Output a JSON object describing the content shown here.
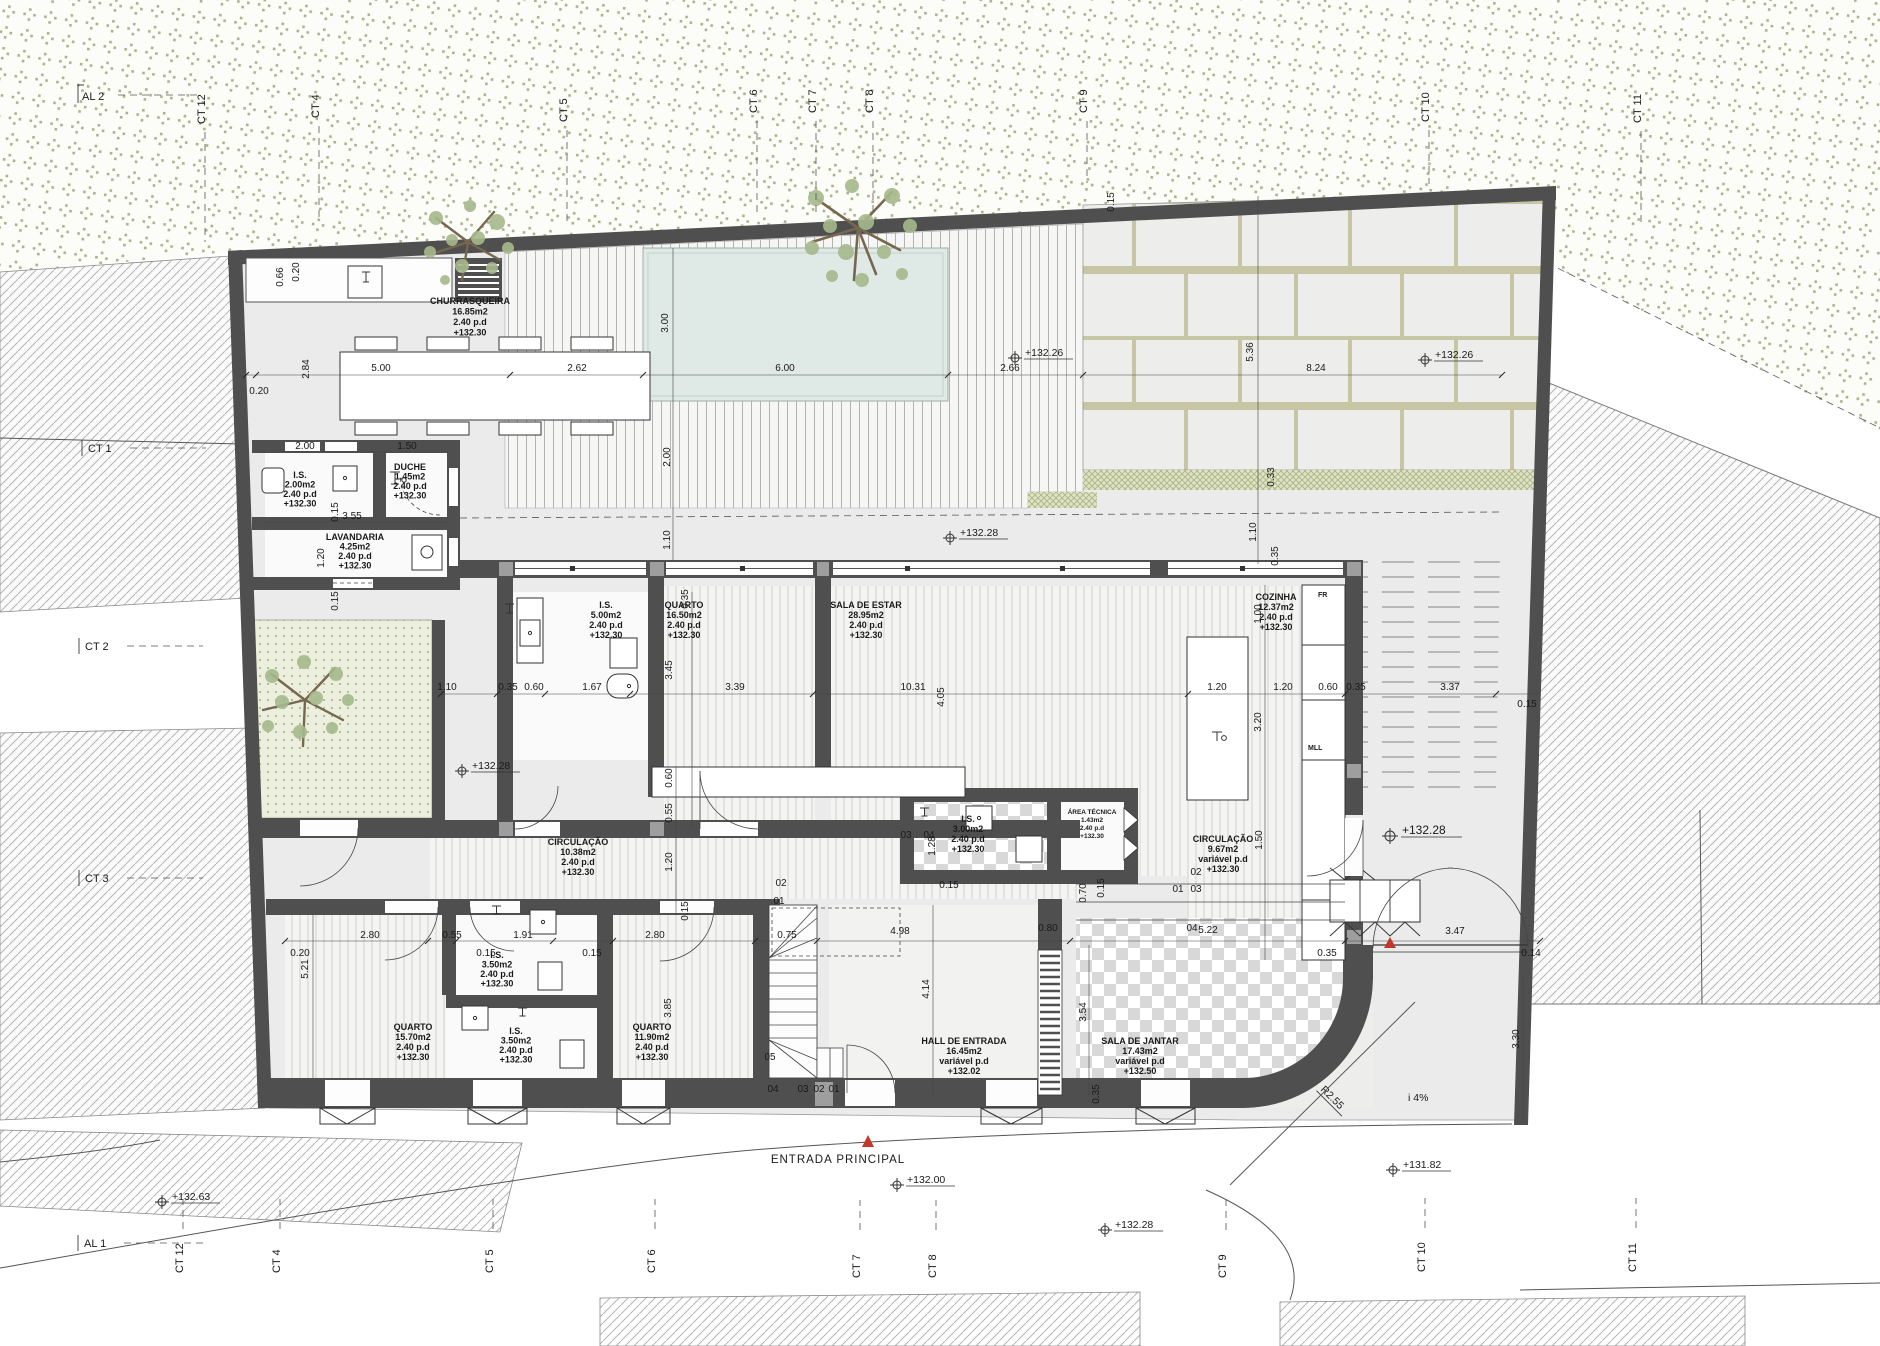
{
  "drawing": {
    "type": "architectural floor plan",
    "entrance_label": "ENTRADA PRINCIPAL",
    "slope_label": "i 4%",
    "radius_label": "R2.55"
  },
  "colors": {
    "wall": "#4f4f4f",
    "pier": "#9e9e9e",
    "pool": "#dfe9e5",
    "vegetation": "#9aa77a",
    "accent_red": "#c0392b",
    "paper": "#ffffff"
  },
  "markers": {
    "top": [
      "AL 2",
      "CT 12",
      "CT 4",
      "CT 5",
      "CT 6",
      "CT 7",
      "CT 8",
      "CT 9",
      "CT 10",
      "CT 11"
    ],
    "left": [
      "CT 1",
      "CT 2",
      "CT 3"
    ],
    "bottom": [
      "AL 1",
      "CT 12",
      "CT 4",
      "CT 5",
      "CT 6",
      "CT 7",
      "CT 8",
      "CT 9",
      "CT 10",
      "CT 11"
    ]
  },
  "rooms": [
    {
      "name": "CHURRASQUEIRA",
      "area": "16.85m2",
      "ceiling": "2.40 p.d",
      "level": "+132.30"
    },
    {
      "name": "I.S.",
      "area": "2.00m2",
      "ceiling": "2.40 p.d",
      "level": "+132.30"
    },
    {
      "name": "DUCHE",
      "area": "1.45m2",
      "ceiling": "2.40 p.d",
      "level": "+132.30"
    },
    {
      "name": "LAVANDARIA",
      "area": "4.25m2",
      "ceiling": "2.40 p.d",
      "level": "+132.30"
    },
    {
      "name": "I.S.",
      "area": "5.00m2",
      "ceiling": "2.40 p.d",
      "level": "+132.30"
    },
    {
      "name": "QUARTO",
      "area": "16.50m2",
      "ceiling": "2.40 p.d",
      "level": "+132.30"
    },
    {
      "name": "SALA DE ESTAR",
      "area": "28.95m2",
      "ceiling": "2.40 p.d",
      "level": "+132.30"
    },
    {
      "name": "COZINHA",
      "area": "12.37m2",
      "ceiling": "2.40 p.d",
      "level": "+132.30"
    },
    {
      "name": "CIRCULAÇÃO",
      "area": "10.38m2",
      "ceiling": "2.40 p.d",
      "level": "+132.30"
    },
    {
      "name": "I.S.",
      "area": "3.00m2",
      "ceiling": "2.40 p.d",
      "level": "+132.30"
    },
    {
      "name": "ÁREA TÉCNICA",
      "area": "1.43m2",
      "ceiling": "2.40 p.d",
      "level": "+132.30"
    },
    {
      "name": "CIRCULAÇÃO",
      "area": "9.67m2",
      "ceiling": "variável p.d",
      "level": "+132.30"
    },
    {
      "name": "QUARTO",
      "area": "15.70m2",
      "ceiling": "2.40 p.d",
      "level": "+132.30"
    },
    {
      "name": "I.S.",
      "area": "3.50m2",
      "ceiling": "2.40 p.d",
      "level": "+132.30"
    },
    {
      "name": "I.S.",
      "area": "3.50m2",
      "ceiling": "2.40 p.d",
      "level": "+132.30"
    },
    {
      "name": "QUARTO",
      "area": "11.90m2",
      "ceiling": "2.40 p.d",
      "level": "+132.30"
    },
    {
      "name": "HALL DE ENTRADA",
      "area": "16.45m2",
      "ceiling": "variável p.d",
      "level": "+132.02"
    },
    {
      "name": "SALA DE JANTAR",
      "area": "17.43m2",
      "ceiling": "variável p.d",
      "level": "+132.50"
    }
  ],
  "appliances": {
    "fridge": "FR",
    "dishwasher": "MLL"
  },
  "elevations": {
    "deck": "+132.26",
    "patio": "+132.26",
    "terrace": "+132.28",
    "courtyard": "+132.28",
    "side_gate": "+132.28",
    "street_mid": "+132.28",
    "street_left": "+132.63",
    "street_front": "+132.00",
    "driveway": "+131.82"
  },
  "dims": [
    "0.20",
    "5.00",
    "2.62",
    "6.00",
    "2.66",
    "8.24",
    "0.66",
    "0.20",
    "2.84",
    "3.00",
    "2.00",
    "1.10",
    "5.36",
    "0.33",
    "1.10",
    "0.35",
    "2.00",
    "1.50",
    "3.55",
    "1.20",
    "0.15",
    "0.15",
    "1.10",
    "0.35",
    "0.60",
    "1.67",
    "3.45",
    "0.35",
    "3.39",
    "10.31",
    "4.05",
    "0.60",
    "0.55",
    "1.20",
    "0.15",
    "1.00",
    "1.20",
    "1.20",
    "0.60",
    "0.35",
    "3.20",
    "3.37",
    "0.15",
    "1.50",
    "0.20",
    "5.21",
    "2.80",
    "0.55",
    "1.91",
    "0.15",
    "0.15",
    "2.80",
    "3.85",
    "0.75",
    "4.98",
    "4.14",
    "3.54",
    "0.35",
    "0.15",
    "0.70",
    "0.15",
    "0.80",
    "5.22",
    "0.35",
    "3.47",
    "0.14",
    "3.30",
    "1.28",
    "0.15"
  ],
  "steps": {
    "stair_lower": [
      "01",
      "02",
      "03",
      "04",
      "05"
    ],
    "stair_upper": [
      "01",
      "02"
    ],
    "entry": [
      "01",
      "02",
      "03",
      "04"
    ],
    "sala": [
      "03",
      "04"
    ]
  }
}
